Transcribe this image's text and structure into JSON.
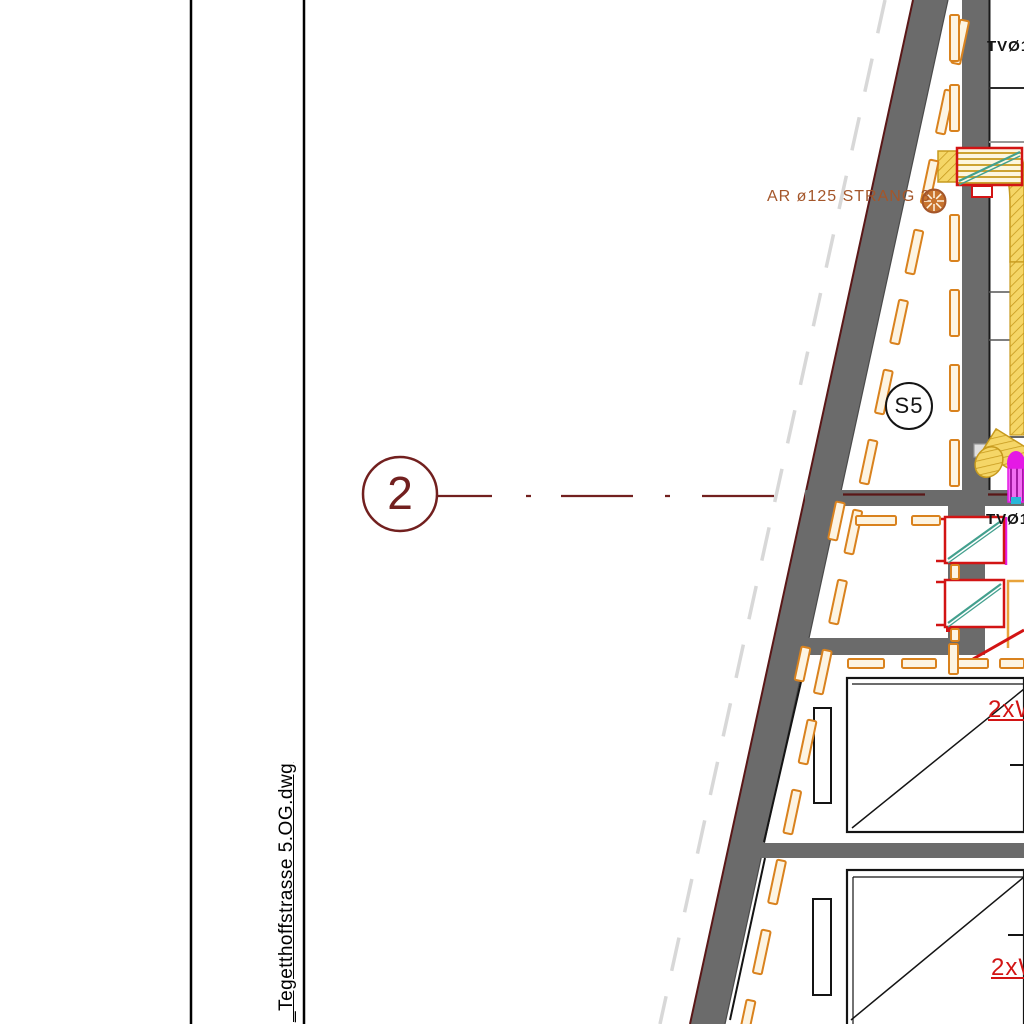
{
  "drawing": {
    "filename_label": "_Tegetthoffstrasse 5.OG.dwg",
    "grid_bubble_label": "2",
    "shaft_bubble_label": "S5",
    "duct_run_label": "AR ø125 STRANG 3",
    "riser_label_top": "TVØ1",
    "riser_label_mid": "TVØ1",
    "window_label_upper": "2xW",
    "window_label_lower": "2xW"
  },
  "icons": {
    "fan_symbol": "radial-fan-icon",
    "fire_damper_upper": "damper-diagonal-icon",
    "fire_damper_mid_1": "damper-diagonal-icon",
    "fire_damper_mid_2": "damper-diagonal-icon"
  },
  "colors": {
    "paper": "#ffffff",
    "ink": "#141414",
    "wall": "#6b6b6b",
    "wallEdge": "#5a1717",
    "maroon": "#72201f",
    "brown": "#a4562a",
    "orange": "#d9821e",
    "orangeFill": "#fdf4e2",
    "orangeLine": "#e8a33a",
    "red": "#d21414",
    "teal": "#43a08e",
    "yellow": "#f5d667",
    "yellowEdge": "#c79a1e",
    "magenta": "#e519e5",
    "cyan": "#29b6d8",
    "ghost": "#d8d8d8",
    "roomGray": "#999999"
  }
}
